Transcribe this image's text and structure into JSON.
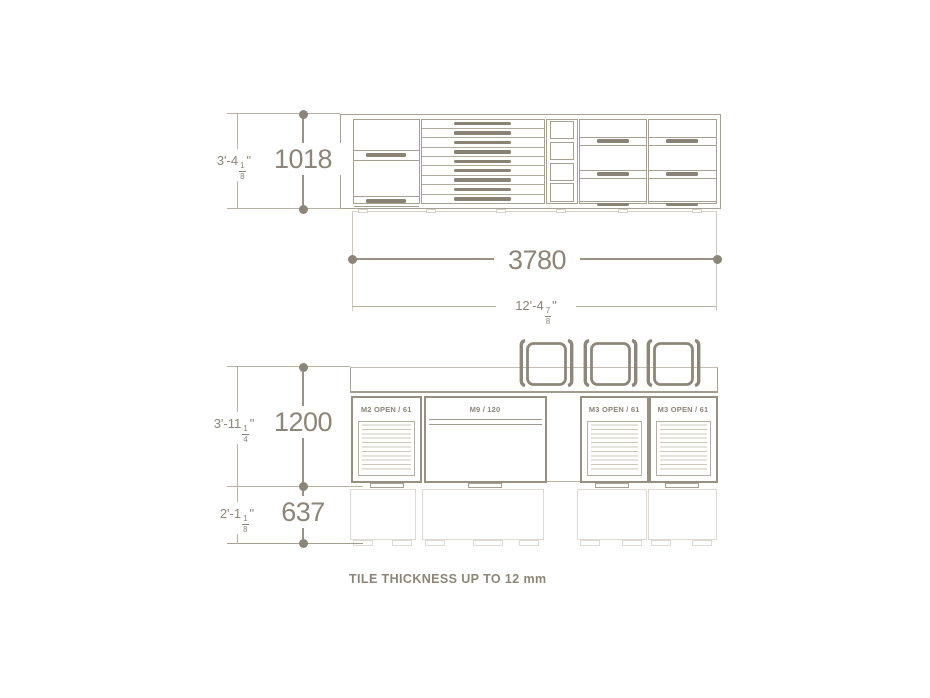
{
  "colors": {
    "line_dark": "#978f81",
    "line_mid": "#a8a193",
    "line_light": "#cfc9bd",
    "ghost_line": "#dedad1",
    "handle": "#8a8375",
    "text": "#8d8577"
  },
  "plan": {
    "dims": {
      "height": {
        "metric": "1018",
        "imp_pre": "3'-4",
        "imp_num": "1",
        "imp_den": "8",
        "imp_unit": "\""
      },
      "width": {
        "metric": "3780",
        "imp_pre": "12'-4",
        "imp_num": "7",
        "imp_den": "8",
        "imp_unit": "\""
      }
    }
  },
  "elevation": {
    "units": [
      {
        "label": "M2 OPEN / 61"
      },
      {
        "label": "M9 / 120"
      },
      {
        "label": "M3 OPEN / 61"
      },
      {
        "label": "M3 OPEN / 61"
      }
    ],
    "chairs_count": 3,
    "dims": {
      "counter_height": {
        "metric": "1200",
        "imp_pre": "3'-11",
        "imp_num": "1",
        "imp_den": "4",
        "imp_unit": "\""
      },
      "base_height": {
        "metric": "637",
        "imp_pre": "2'-1",
        "imp_num": "1",
        "imp_den": "8",
        "imp_unit": "\""
      }
    }
  },
  "note": {
    "text": "TILE THICKNESS UP TO 12 mm"
  }
}
